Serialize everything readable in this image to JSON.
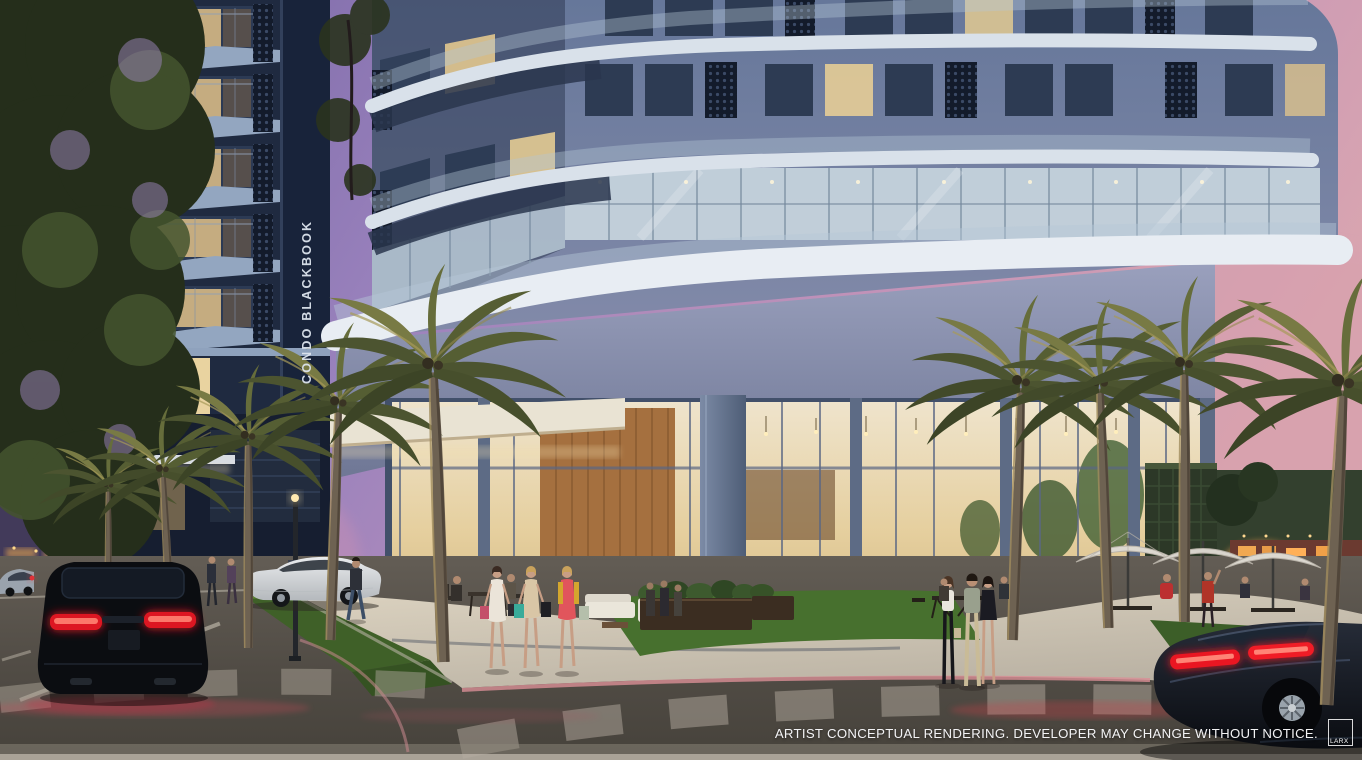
{
  "watermark": {
    "vertical_label": "CONDO BLACKBOOK"
  },
  "disclaimer": {
    "text": "ARTIST CONCEPTUAL RENDERING. DEVELOPER MAY CHANGE WITHOUT NOTICE.",
    "logo_text": "LARX"
  },
  "palette": {
    "sky_purple": "#8a76b0",
    "sky_pink": "#d9a5b0",
    "facade_blue": "#6b7b9c",
    "slab_white": "#e8edf3",
    "dark_navy": "#18233a",
    "warm_window": "#e3ca92",
    "taillight_red": "#e01824",
    "palm_green": "#4c5430",
    "grass_green": "#3f6028",
    "sidewalk_tan": "#cfc6b6",
    "asphalt_gray": "#54504a",
    "watermark_text": "#dde4ee",
    "disclaimer_text": "#f3f3f5"
  }
}
